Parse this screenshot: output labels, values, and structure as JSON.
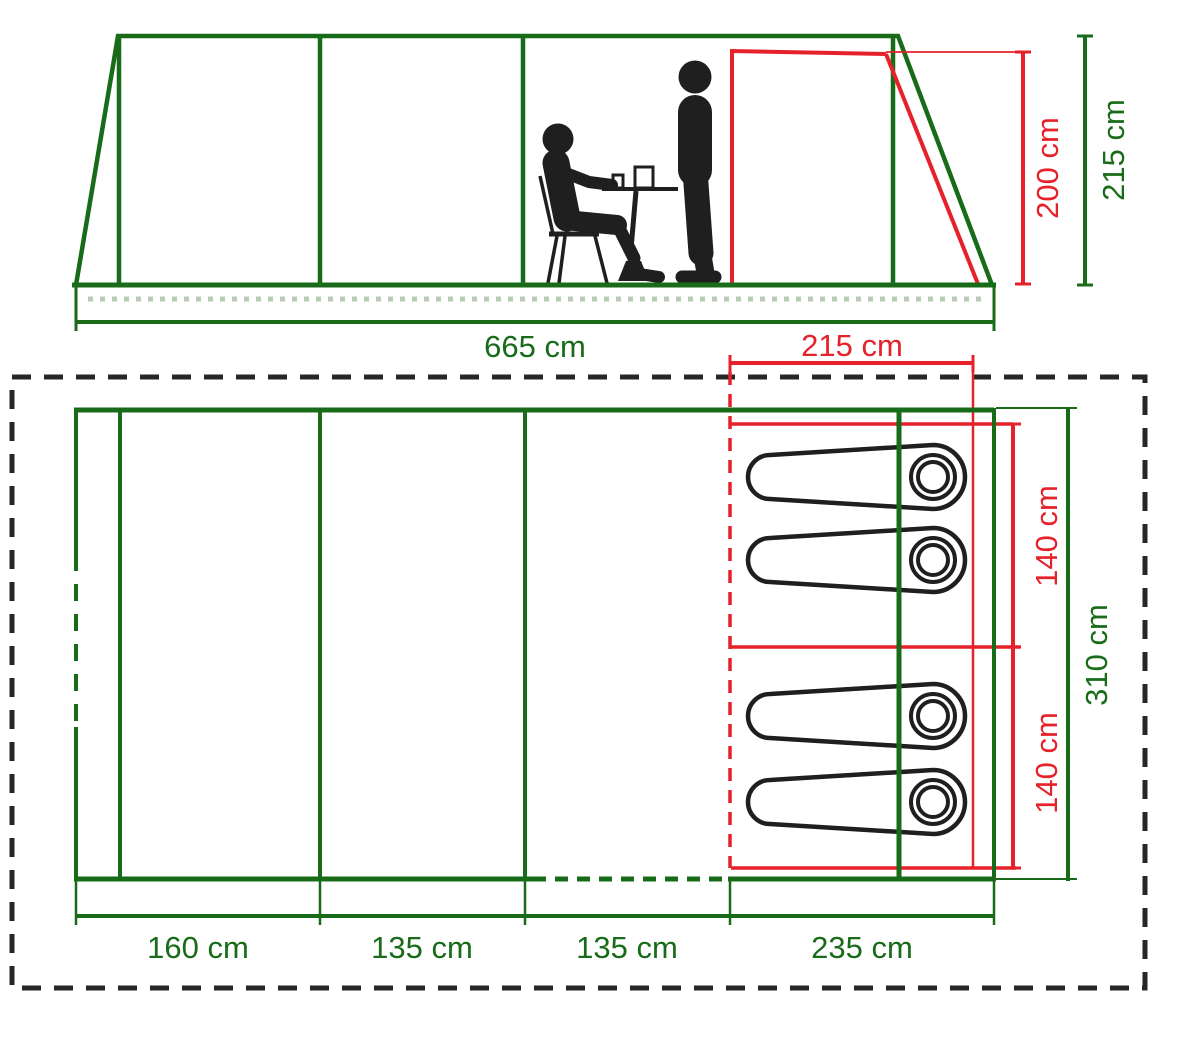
{
  "title": "Tent dimensions diagram",
  "colors": {
    "green": "#186b18",
    "red": "#e62129",
    "ink": "#1f1f1f",
    "dot": "#b5cdb5",
    "border": "#262626"
  },
  "side_view": {
    "total_length": "665 cm",
    "bedroom_length": "215 cm",
    "inner_height": "200 cm",
    "peak_height": "215 cm"
  },
  "floor_plan": {
    "total_width": "310 cm",
    "bed_widths": [
      "140 cm",
      "140 cm"
    ],
    "section_lengths": [
      "160 cm",
      "135 cm",
      "135 cm",
      "235 cm"
    ],
    "sleeping_bag_count": 4
  }
}
